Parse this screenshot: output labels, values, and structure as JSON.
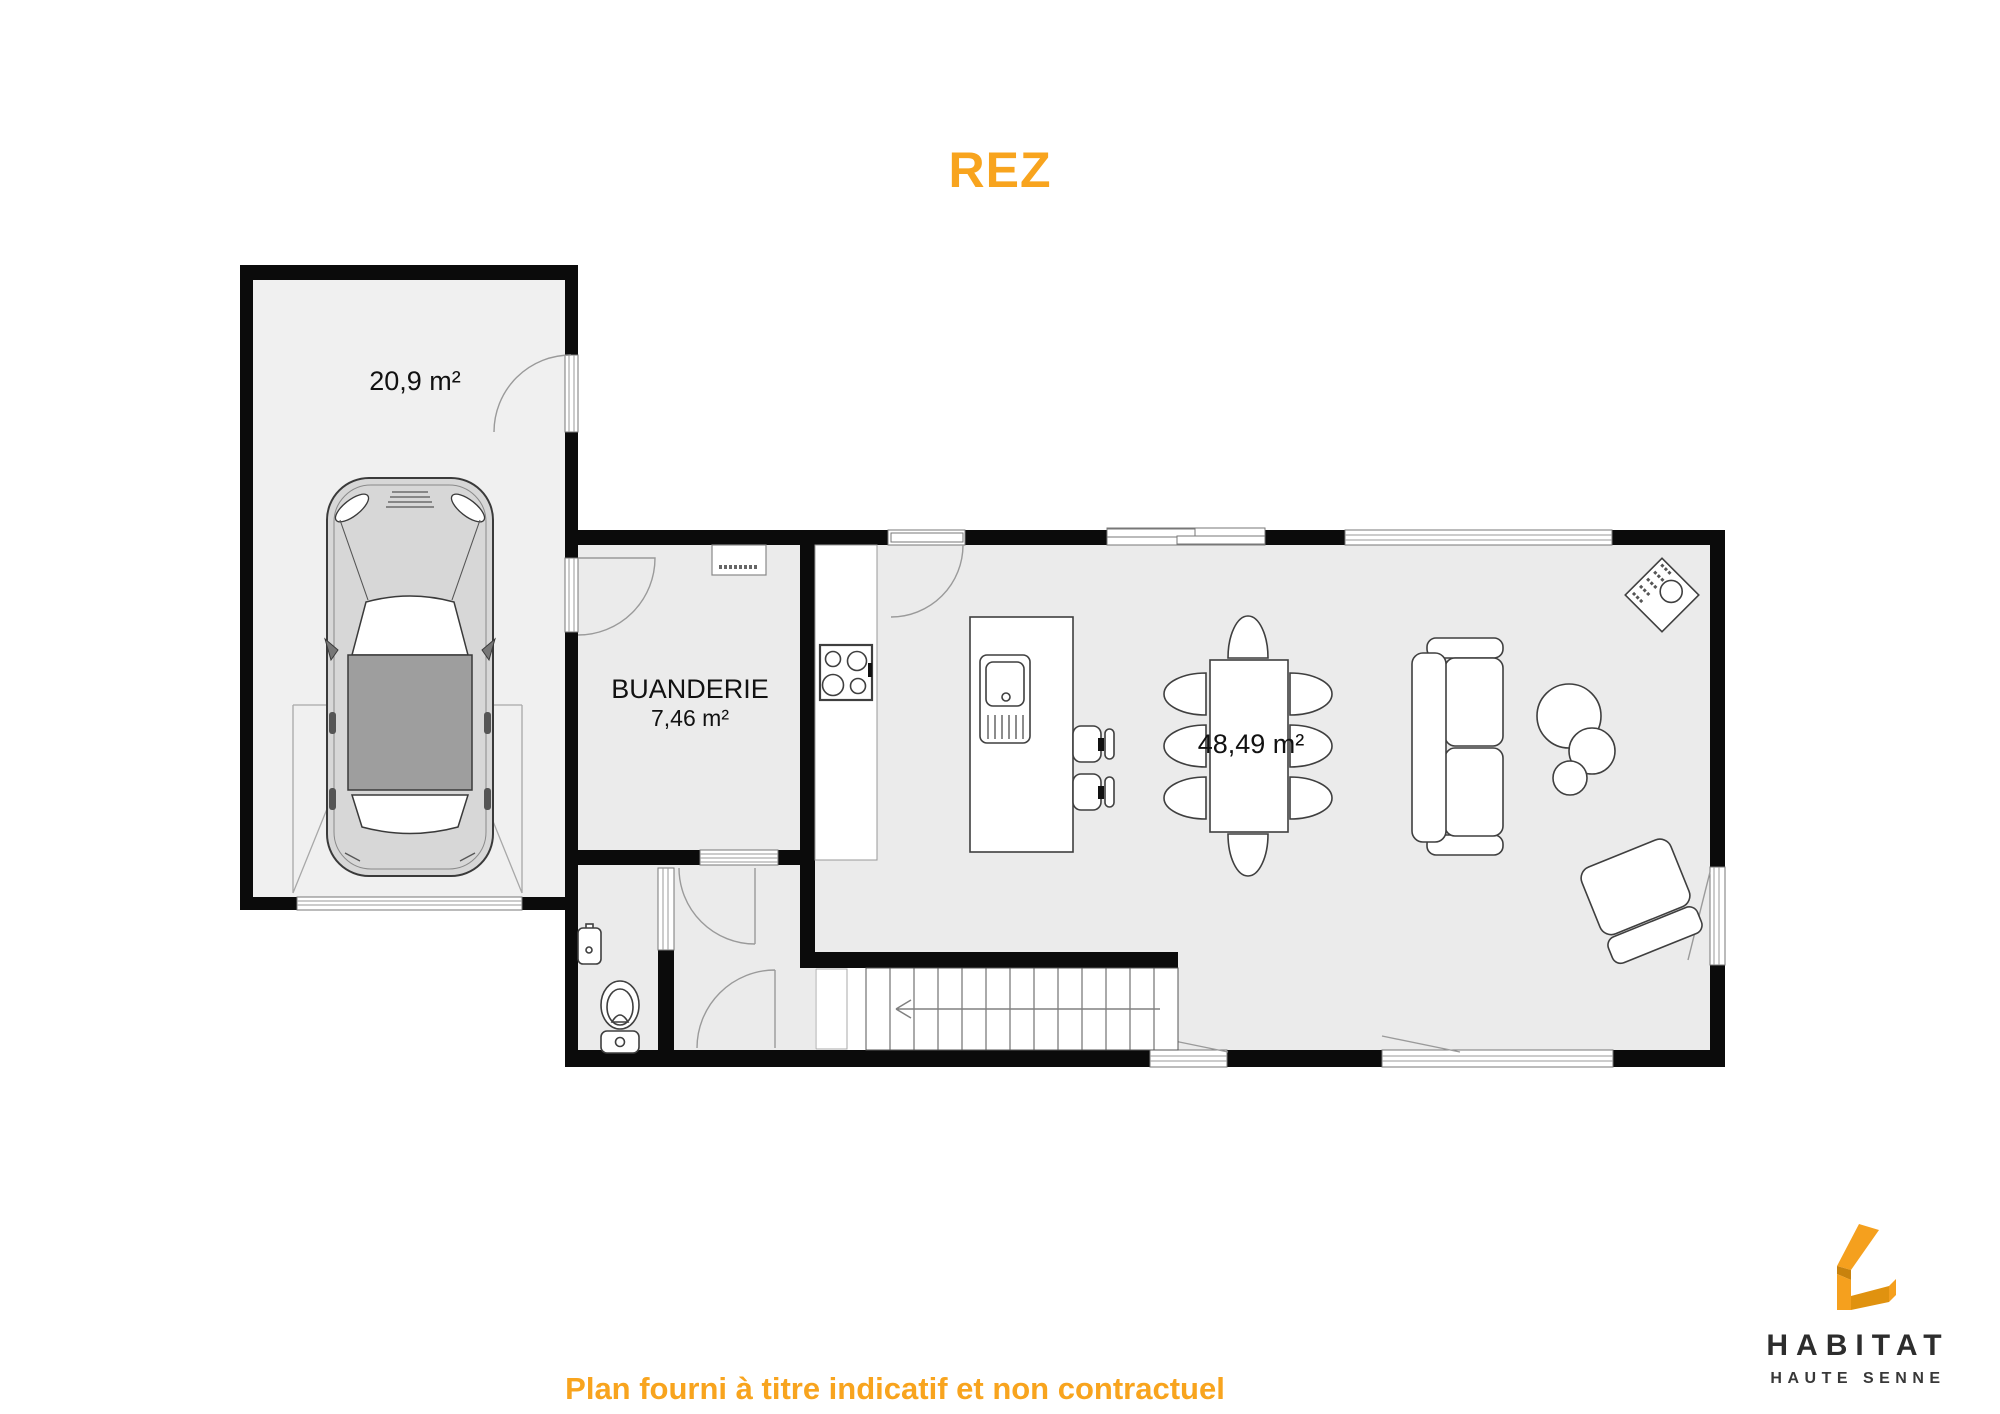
{
  "title": "REZ",
  "footer": "Plan fourni à titre indicatif et non contractuel",
  "rooms": {
    "garage": {
      "area": "20,9 m²"
    },
    "buanderie": {
      "name": "BUANDERIE",
      "area": "7,46 m²"
    },
    "sejour": {
      "area": "48,49 m²"
    }
  },
  "logo": {
    "name": "HABITAT",
    "subtitle": "HAUTE SENNE"
  },
  "colors": {
    "accent": "#F8A41E",
    "wall": "#0B0B0B",
    "room": "#EBEBEB",
    "garage": "#F0F0F0",
    "logo-orange": "#F5A01E",
    "logo-dark": "#C8820D",
    "logo-mid": "#E0920F",
    "logo-text": "#2D2D2D"
  }
}
